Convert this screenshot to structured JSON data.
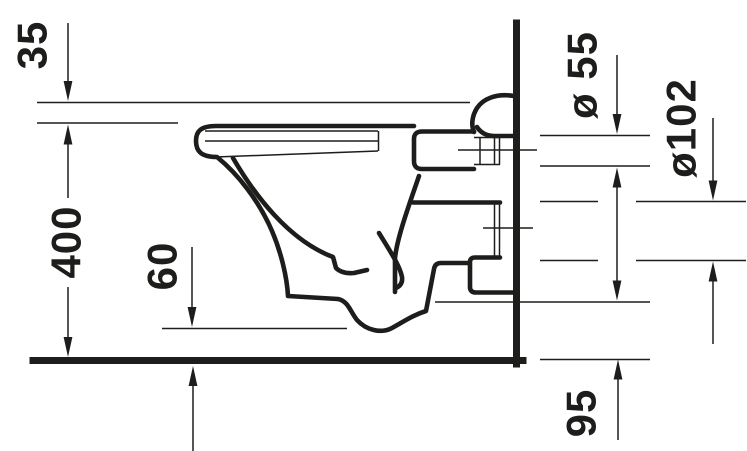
{
  "drawing": {
    "kind": "toilet-side-elevation-technical-drawing",
    "colors": {
      "line": "#1d1d1b",
      "background": "#ffffff"
    }
  },
  "dims": {
    "seat": {
      "label": "35"
    },
    "height": {
      "label": "400"
    },
    "bottom_clearance": {
      "label": "60"
    },
    "flush_inlet": {
      "label": "ø 55"
    },
    "outlet": {
      "label": "ø102"
    },
    "outlet_offset": {
      "label": "95"
    }
  }
}
